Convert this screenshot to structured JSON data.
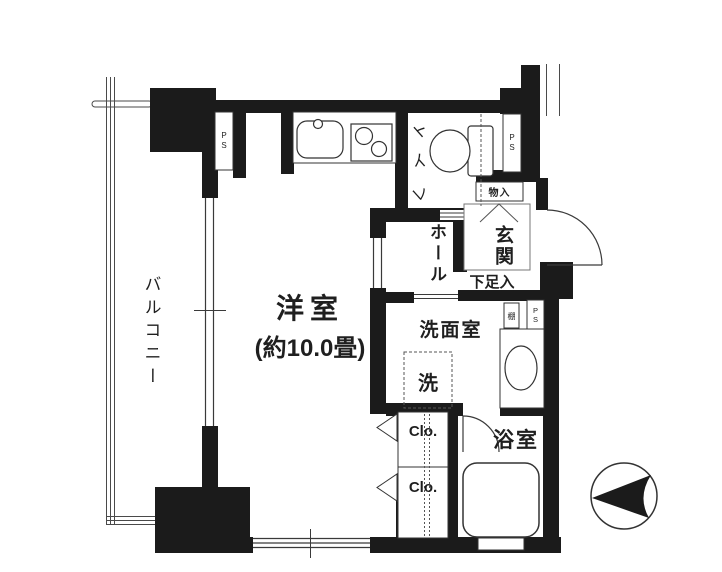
{
  "floor_plan": {
    "balcony_label": "バルコニー",
    "main_room_label": "洋室",
    "main_room_size": "(約10.0畳)",
    "toilet_label": "トイレ",
    "hall_label": "ホール",
    "entrance_label": "玄関",
    "shoe_cupboard_label": "下足入",
    "storage_label": "物入",
    "washroom_label": "洗面室",
    "washing_machine_label": "洗",
    "shelf_label": "棚",
    "closet_upper_label": "Clo.",
    "closet_lower_label": "Clo.",
    "bathroom_label": "浴室",
    "pipe_space_kitchen": "PS",
    "pipe_space_toilet": "PS",
    "pipe_space_washroom": "PS"
  },
  "colors": {
    "wall": "#1b1b1b",
    "line": "#3a3a3a",
    "background": "#ffffff"
  }
}
